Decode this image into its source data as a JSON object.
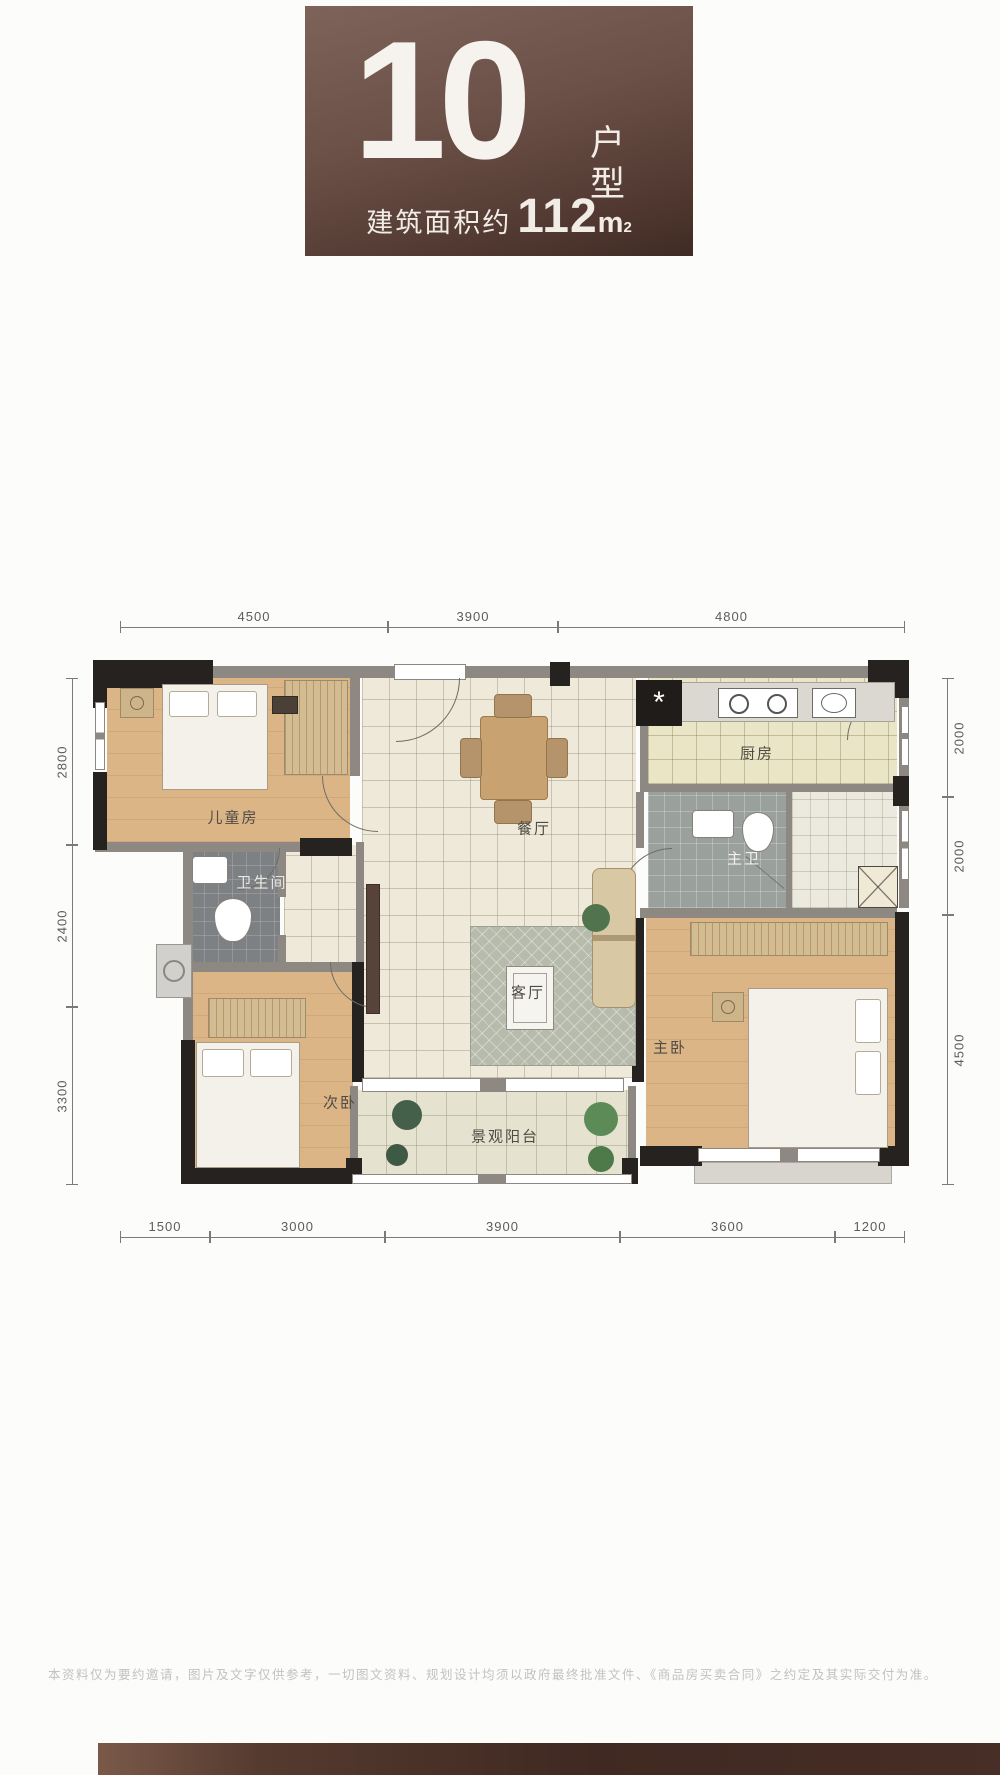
{
  "header": {
    "unit_number": "10",
    "unit_label_vertical": "户型",
    "area_prefix": "建筑面积约",
    "area_value": "112",
    "area_unit_base": "m",
    "area_unit_sup": "2"
  },
  "floorplan": {
    "rooms": {
      "children": "儿童房",
      "bathroom": "卫生间",
      "second_bedroom": "次卧",
      "dining": "餐厅",
      "living": "客厅",
      "balcony": "景观阳台",
      "kitchen": "厨房",
      "master_bathroom": "主卫",
      "master_bedroom": "主卧"
    },
    "dimensions": {
      "top": [
        "4500",
        "3900",
        "4800"
      ],
      "bottom": [
        "1500",
        "3000",
        "3900",
        "3600",
        "1200"
      ],
      "left": [
        "2800",
        "2400",
        "3300"
      ],
      "right": [
        "2000",
        "2000",
        "4500"
      ]
    }
  },
  "footer": {
    "disclaimer": "本资料仅为要约邀请，图片及文字仅供参考，一切图文资料、规划设计均须以政府最终批准文件、《商品房买卖合同》之约定及其实际交付为准。"
  },
  "colors": {
    "panel_brown": "#6b5047",
    "wall_dark": "#26221f",
    "wall_gray": "#8d8982",
    "wood_floor": "#dcb587"
  }
}
